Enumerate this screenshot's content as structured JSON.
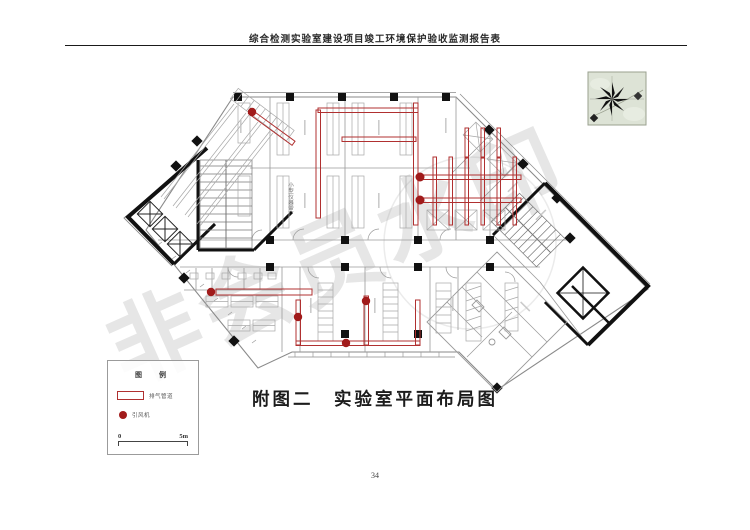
{
  "page": {
    "header_title": "综合检测实验室建设项目竣工环境保护验收监测报告表",
    "caption": "附图二　实验室平面布局图",
    "page_number": "34"
  },
  "floor_plan": {
    "watermark_text": "非会员水印",
    "room_labels": [
      {
        "text": "小型仪器室"
      }
    ],
    "colors": {
      "pipe_red": "#b03030",
      "fan_red": "#a11b1b",
      "wall_black": "#111111",
      "outline_gray": "#8a8a8a",
      "north_bg": "#dde3d6",
      "watermark_gray": "#d9d9d9"
    }
  },
  "legend": {
    "title": "图　例",
    "items": [
      {
        "symbol": "pipe-rect-outline",
        "label": "排气管道"
      },
      {
        "symbol": "fan-filled-circle",
        "label": "引风机"
      }
    ],
    "scale": {
      "start": "0",
      "end": "5m"
    }
  }
}
